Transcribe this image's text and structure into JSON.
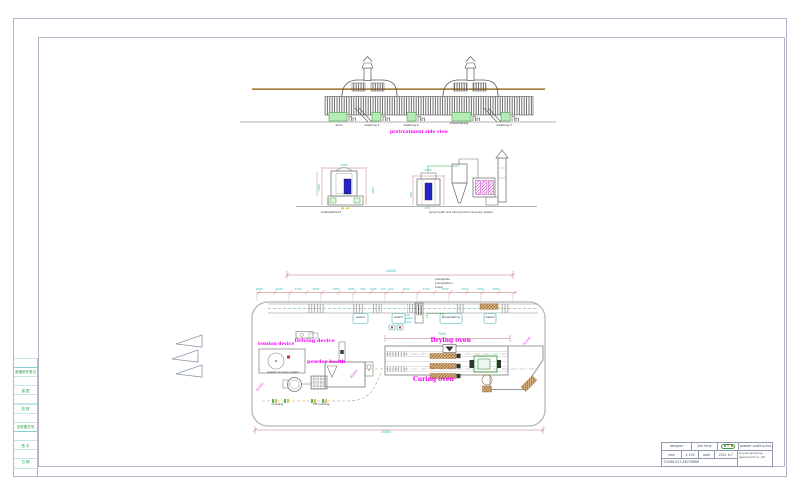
{
  "drawing": {
    "top_view": {
      "title": "pretreatment side view",
      "stations": [
        "skim",
        "washing 1",
        "washing 2",
        "phosphating",
        "washing 3"
      ]
    },
    "elevations": {
      "left_label": "pretreatment",
      "right_label": "spray booth and monocyclone recovery system",
      "left_dims": {
        "top": "2250",
        "left": "1500",
        "right": "3350",
        "base": "950"
      },
      "right_dims": {
        "top": "1500",
        "left": "850",
        "base": "150"
      }
    },
    "plan": {
      "overall_top": "24050",
      "overall_bottom": "20000",
      "oven_dim": "7000",
      "dim_chain": [
        "1500",
        "2220",
        "1700",
        "2000",
        "1450",
        "1500",
        "980",
        "1443",
        "140",
        "900",
        "1500",
        "1700",
        "1500",
        "1500",
        "1700",
        "2000"
      ],
      "tower_note": [
        "phosphate",
        "precipitation",
        "tower"
      ],
      "hot_tank_note": [
        "hot",
        "water",
        "tank"
      ],
      "stations": [
        "wash1",
        "wash2",
        "phosphating",
        "wash3"
      ],
      "labels": {
        "driving_device": "Driving device",
        "tension_device": "tension device",
        "powder_booth": "powder booth",
        "powder_recovery": "powder recovery system",
        "drying_oven": "Drying oven",
        "curing_oven": "Curing oven",
        "loading": "Loading",
        "off_loading": "Off loading"
      },
      "radius_dims": [
        "R1500",
        "R2000",
        "R1500"
      ]
    }
  },
  "frame": {
    "left_rows": [
      "借通用件登记",
      "描 图",
      "校 核",
      "旧底图总号",
      "签 字",
      "日 期"
    ]
  },
  "title_block": {
    "designer_label": "designer",
    "designer_value": "jian feng",
    "scale_label": "rate",
    "scale_value": "1:100",
    "date_label": "date",
    "date_value": "2021.6.7",
    "phone": "T:0086-523-88759666",
    "product": "powder coating line",
    "company_lines": [
      "xinyue spraying",
      "equipment co.,ltd"
    ],
    "logo": "green-oval-logo"
  },
  "colors": {
    "magenta": "#f400f4",
    "cyan_dim": "#2ab4b4",
    "dim_red": "#c07070",
    "tank_green": "#b5ecb5",
    "accent_green": "#44a044",
    "brown": "#a97f3f",
    "deep_blue": "#2424c8",
    "frame_gray": "#b4b4c8"
  }
}
